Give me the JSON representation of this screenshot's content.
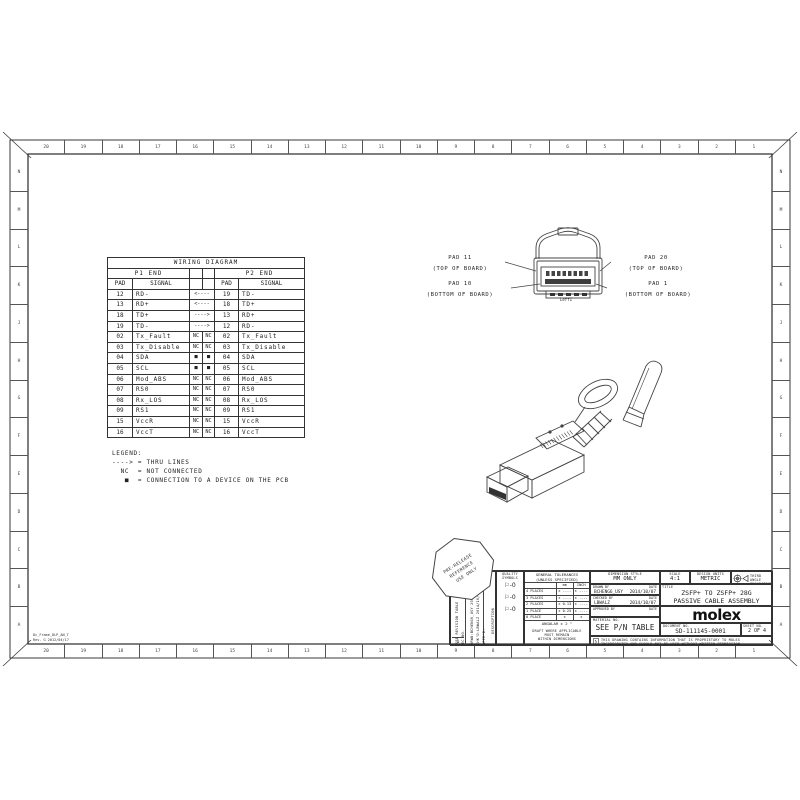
{
  "ink": "#2b2b2b",
  "border": {
    "top_zones": [
      "20",
      "19",
      "18",
      "17",
      "16",
      "15",
      "14",
      "13",
      "12",
      "11",
      "10",
      "9",
      "8",
      "7",
      "6",
      "5",
      "4",
      "3",
      "2",
      "1"
    ],
    "bottom_zones": [
      "20",
      "19",
      "18",
      "17",
      "16",
      "15",
      "14",
      "13",
      "12",
      "11",
      "10",
      "9",
      "8",
      "7",
      "6",
      "5",
      "4",
      "3",
      "2",
      "1"
    ],
    "left_zones": [
      "N",
      "M",
      "L",
      "K",
      "J",
      "H",
      "G",
      "F",
      "E",
      "D",
      "C",
      "B",
      "A"
    ],
    "right_zones": [
      "N",
      "M",
      "L",
      "K",
      "J",
      "H",
      "G",
      "F",
      "E",
      "D",
      "C",
      "B",
      "A"
    ],
    "frame_note_line1": "Dc_Frame_DLP_AN_T",
    "frame_note_line2": "Rev. G 2012/04/17"
  },
  "wiring_table": {
    "title": "WIRING DIAGRAM",
    "p1_header": "P1 END",
    "p2_header": "P2 END",
    "col_pad": "PAD",
    "col_signal": "SIGNAL",
    "rows": [
      {
        "p1_pad": "12",
        "p1_signal": "RD-",
        "mid": "<----",
        "p2_pad": "19",
        "p2_signal": "TD-"
      },
      {
        "p1_pad": "13",
        "p1_signal": "RD+",
        "mid": "<----",
        "p2_pad": "18",
        "p2_signal": "TD+"
      },
      {
        "p1_pad": "18",
        "p1_signal": "TD+",
        "mid": "---->",
        "p2_pad": "13",
        "p2_signal": "RD+"
      },
      {
        "p1_pad": "19",
        "p1_signal": "TD-",
        "mid": "---->",
        "p2_pad": "12",
        "p2_signal": "RD-"
      },
      {
        "p1_pad": "02",
        "p1_signal": "Tx_Fault",
        "mid_l": "NC",
        "mid_r": "NC",
        "p2_pad": "02",
        "p2_signal": "Tx_Fault"
      },
      {
        "p1_pad": "03",
        "p1_signal": "Tx_Disable",
        "mid_l": "NC",
        "mid_r": "NC",
        "p2_pad": "03",
        "p2_signal": "Tx_Disable"
      },
      {
        "p1_pad": "04",
        "p1_signal": "SDA",
        "mid_l": "■",
        "mid_r": "■",
        "p2_pad": "04",
        "p2_signal": "SDA"
      },
      {
        "p1_pad": "05",
        "p1_signal": "SCL",
        "mid_l": "■",
        "mid_r": "■",
        "p2_pad": "05",
        "p2_signal": "SCL"
      },
      {
        "p1_pad": "06",
        "p1_signal": "Mod_ABS",
        "mid_l": "NC",
        "mid_r": "NC",
        "p2_pad": "06",
        "p2_signal": "Mod_ABS"
      },
      {
        "p1_pad": "07",
        "p1_signal": "RS0",
        "mid_l": "NC",
        "mid_r": "NC",
        "p2_pad": "07",
        "p2_signal": "RS0"
      },
      {
        "p1_pad": "08",
        "p1_signal": "Rx_LOS",
        "mid_l": "NC",
        "mid_r": "NC",
        "p2_pad": "08",
        "p2_signal": "Rx_LOS"
      },
      {
        "p1_pad": "09",
        "p1_signal": "RS1",
        "mid_l": "NC",
        "mid_r": "NC",
        "p2_pad": "09",
        "p2_signal": "RS1"
      },
      {
        "p1_pad": "15",
        "p1_signal": "VccR",
        "mid_l": "NC",
        "mid_r": "NC",
        "p2_pad": "15",
        "p2_signal": "VccR"
      },
      {
        "p1_pad": "16",
        "p1_signal": "VccT",
        "mid_l": "NC",
        "mid_r": "NC",
        "p2_pad": "16",
        "p2_signal": "VccT"
      }
    ]
  },
  "legend": {
    "lines": [
      "LEGEND:",
      "----> = THRU LINES",
      "  NC  = NOT CONNECTED",
      "   ■  = CONNECTION TO A DEVICE ON THE PCB"
    ]
  },
  "pad_callouts": {
    "top_left_line1": "PAD 11",
    "top_left_line2": "(TOP OF BOARD)",
    "bottom_left_line1": "PAD 10",
    "bottom_left_line2": "(BOTTOM OF BOARD)",
    "top_right_line1": "PAD 20",
    "top_right_line2": "(TOP OF BOARD)",
    "bottom_right_line1": "PAD 1",
    "bottom_right_line2": "(BOTTOM OF BOARD)",
    "view_label": "Leff1"
  },
  "stamp": [
    "PRE-RELEASE",
    "REFERENCE",
    "USE ONLY"
  ],
  "title_block": {
    "quality_header1": "QUALITY",
    "quality_header2": "SYMBOLS",
    "quality_flags": [
      "⚐-0",
      "⚐-0",
      "⚐-0"
    ],
    "tol_header1": "GENERAL TOLERANCES",
    "tol_header2": "(UNLESS SPECIFIED)",
    "tol_col_mm": "mm",
    "tol_col_inch": "INCH",
    "tol_rows": [
      [
        "4 PLACES",
        "± ----",
        "± ----"
      ],
      [
        "3 PLACES",
        "± ----",
        "± ----"
      ],
      [
        "2 PLACES",
        "± 0.13",
        "± ----"
      ],
      [
        "1 PLACE",
        "± 0.25",
        "± ----"
      ],
      [
        "0 PLACE",
        "±",
        "±"
      ]
    ],
    "angular": "ANGULAR ± 2 °",
    "draft_note1": "DRAFT WHERE APPLICABLE",
    "draft_note2": "MUST REMAIN",
    "draft_note3": "WITHIN DIMENSIONS",
    "dim_style_label": "DIMENSION STYLE",
    "dim_style_value": "MM ONLY",
    "drawn_label": "DRAWN BY",
    "drawn_date_label": "DATE",
    "drawn_name": "BCHENG6_USY",
    "drawn_date": "2014/10/07",
    "checked_label": "CHECKED BY",
    "checked_date_label": "DATE",
    "checked_name": "LBWALZ",
    "checked_date": "2014/10/07",
    "approved_label": "APPROVED BY",
    "approved_date_label": "DATE",
    "approved_name": "",
    "approved_date": "",
    "material_label": "MATERIAL NO.",
    "material_value": "SEE P/N TABLE",
    "scale_label": "SCALE",
    "scale_value": "4:1",
    "units_label": "DESIGN UNITS",
    "units_value": "METRIC",
    "projection_label1": "THIRD ANGLE",
    "projection_label2": "PROJECTION",
    "title_label": "TITLE",
    "title_line1": "ZSFP+ TO ZSFP+ 28G",
    "title_line2": "PASSIVE CABLE ASSEMBLY",
    "logo": "molex",
    "document_label": "DOCUMENT NO.",
    "document_value": "SD-111145-0001",
    "sheet_label": "SHEET NO.",
    "sheet_value": "2 OF 4",
    "disclaimer1": "THIS DRAWING CONTAINS INFORMATION THAT IS PROPRIETARY TO MOLEX",
    "disclaimer2": "INCORPORATED AND SHOULD NOT BE USED WITHOUT WRITTEN PERMISSION",
    "revision": {
      "see_rev": "SEE REVISION TABLE",
      "ec_no": "EC NO.",
      "drwn": "DRWN:BCHENG6_USY 2014/10/07",
      "chkd": "CHK'D:LBWALZ 2014/10/07",
      "appr": "APPR'D:",
      "description": "DESCRIPTION",
      "rev_num": "1"
    }
  }
}
